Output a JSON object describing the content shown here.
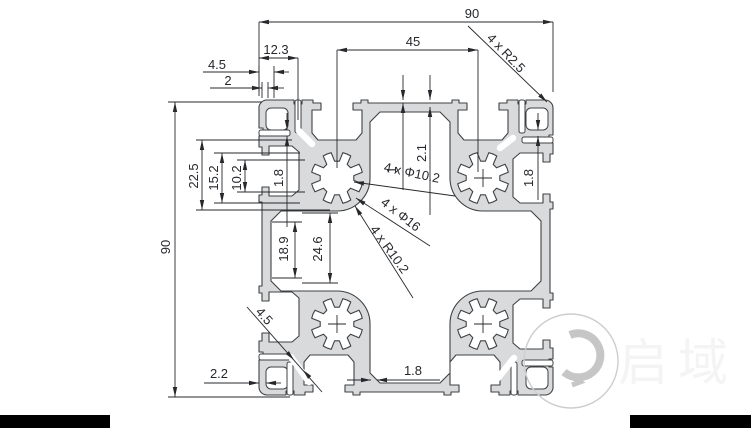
{
  "drawing_title": "90x90 aluminium extrusion profile cross-section",
  "colors": {
    "metal_fill": "#d9dadb",
    "outline": "#3f4143",
    "dim_line": "#26282c",
    "watermark": "#c3c3c3",
    "bar": "#000000"
  },
  "dimensions": {
    "top_width": "90",
    "slot_pitch": "45",
    "d_12_3": "12.3",
    "d_top_4_5": "4.5",
    "d_top_2": "2",
    "left_height": "90",
    "d_22_5": "22.5",
    "d_15_2": "15.2",
    "d_10_2": "10.2",
    "d_left_1_8": "1.8",
    "d_1": "1",
    "d_2_1": "2.1",
    "d_right_1_8": "1.8",
    "d_18_9": "18.9",
    "d_24_6": "24.6",
    "d_2_2": "2.2",
    "d_bottom_1_8": "1.8",
    "d_corner_4_5": "4.5"
  },
  "callouts": {
    "corner_radius": "4 x R2.5",
    "bore_dia": "4 x Φ10.2",
    "core_dia": "4 x Φ16",
    "boss_radius": "4 x R10.2"
  },
  "logo": {
    "text": "启域"
  }
}
